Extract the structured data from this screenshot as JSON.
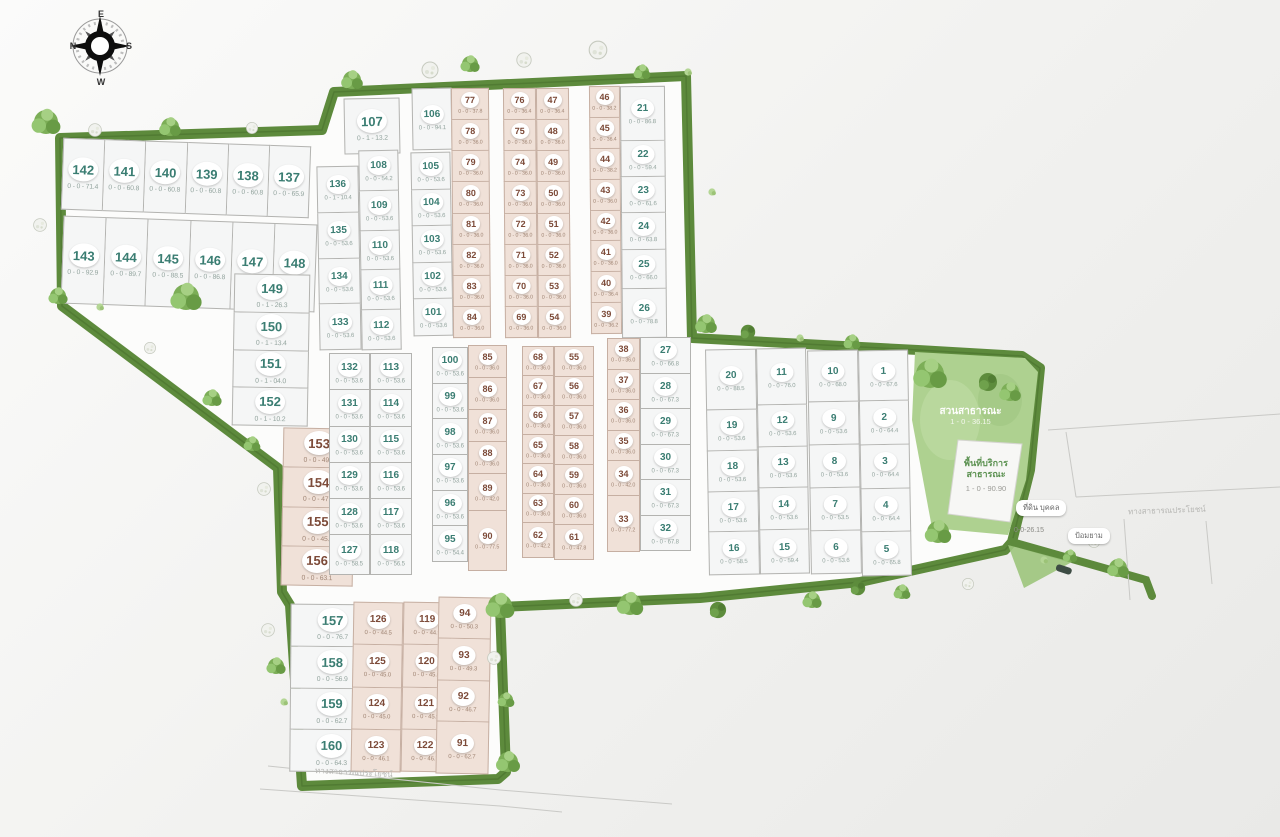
{
  "compass": {
    "n": "N",
    "e": "E",
    "s": "S",
    "w": "W"
  },
  "park": {
    "name": "สวนสาธารณะ",
    "area": "1 - 0 - 36.15"
  },
  "service": {
    "line1": "พื้นที่บริการ",
    "line2": "สาธารณะ",
    "area": "1 - 0 - 90.90"
  },
  "labels": {
    "private_land": "ที่ดิน บุคคล",
    "guard_house": "ป้อมยาม",
    "road_right": "ทางสาธารณประโยชน์",
    "road_bottom": "ทางสาธารณประโยชน์",
    "spur_area": "0-0-26.15"
  },
  "colors": {
    "plot_green_number": "#3a7d72",
    "plot_pink_number": "#7c4a38",
    "border_green": "#5d8a3c",
    "park_fill": "#aed190"
  },
  "groups": [
    {
      "id": "rowA",
      "dir": "h",
      "style": "green",
      "sz": "lg",
      "plots": [
        {
          "n": "142",
          "a": "0 - 0 - 71.4"
        },
        {
          "n": "141",
          "a": "0 - 0 - 60.8"
        },
        {
          "n": "140",
          "a": "0 - 0 - 60.8"
        },
        {
          "n": "139",
          "a": "0 - 0 - 60.8"
        },
        {
          "n": "138",
          "a": "0 - 0 - 60.8"
        },
        {
          "n": "137",
          "a": "0 - 0 - 65.9"
        }
      ]
    },
    {
      "id": "rowB",
      "dir": "h",
      "style": "green",
      "sz": "lg",
      "plots": [
        {
          "n": "143",
          "a": "0 - 0 - 92.9"
        },
        {
          "n": "144",
          "a": "0 - 0 - 89.7"
        },
        {
          "n": "145",
          "a": "0 - 0 - 88.5"
        },
        {
          "n": "146",
          "a": "0 - 0 - 86.8"
        },
        {
          "n": "147",
          "a": "0 - 0 - 78.9"
        },
        {
          "n": "148",
          "a": "0 - 0 - 80.9"
        }
      ]
    },
    {
      "id": "col149",
      "dir": "v",
      "style": "green",
      "sz": "lg",
      "plots": [
        {
          "n": "149",
          "a": "0 - 1 - 26.3"
        },
        {
          "n": "150",
          "a": "0 - 1 - 13.4"
        },
        {
          "n": "151",
          "a": "0 - 1 - 04.0"
        },
        {
          "n": "152",
          "a": "0 - 1 - 10.2"
        }
      ]
    },
    {
      "id": "col153",
      "dir": "v",
      "style": "pink",
      "sz": "lg",
      "plots": [
        {
          "n": "153",
          "a": "0 - 0 - 49.6"
        },
        {
          "n": "154",
          "a": "0 - 0 - 47.7"
        },
        {
          "n": "155",
          "a": "0 - 0 - 45.8"
        },
        {
          "n": "156",
          "a": "0 - 0 - 63.1"
        }
      ]
    },
    {
      "id": "col157",
      "dir": "v",
      "style": "green",
      "sz": "lg",
      "plots": [
        {
          "n": "157",
          "a": "0 - 0 - 76.7"
        },
        {
          "n": "158",
          "a": "0 - 0 - 56.9"
        },
        {
          "n": "159",
          "a": "0 - 0 - 62.7"
        },
        {
          "n": "160",
          "a": "0 - 0 - 64.3"
        }
      ]
    },
    {
      "id": "col126",
      "dir": "v",
      "style": "pink",
      "sz": "md",
      "plots": [
        {
          "n": "126",
          "a": "0 - 0 - 44.5"
        },
        {
          "n": "125",
          "a": "0 - 0 - 45.0"
        },
        {
          "n": "124",
          "a": "0 - 0 - 45.0"
        },
        {
          "n": "123",
          "a": "0 - 0 - 46.1"
        }
      ]
    },
    {
      "id": "col119",
      "dir": "v",
      "style": "pink",
      "sz": "md",
      "plots": [
        {
          "n": "119",
          "a": "0 - 0 - 44.9"
        },
        {
          "n": "120",
          "a": "0 - 0 - 45.0"
        },
        {
          "n": "121",
          "a": "0 - 0 - 45.9"
        },
        {
          "n": "122",
          "a": "0 - 0 - 46.7"
        }
      ]
    },
    {
      "id": "col94",
      "dir": "v",
      "style": "pink",
      "sz": "md",
      "plots": [
        {
          "n": "94",
          "a": "0 - 0 - 50.3"
        },
        {
          "n": "93",
          "a": "0 - 0 - 49.3"
        },
        {
          "n": "92",
          "a": "0 - 0 - 46.7"
        },
        {
          "n": "91",
          "a": "0 - 0 - 62.7",
          "f": 1.25
        }
      ]
    },
    {
      "id": "plot107",
      "dir": "v",
      "style": "green",
      "sz": "lg",
      "plots": [
        {
          "n": "107",
          "a": "0 - 1 - 13.2"
        }
      ]
    },
    {
      "id": "col136",
      "dir": "v",
      "style": "green",
      "sz": "md",
      "plots": [
        {
          "n": "136",
          "a": "0 - 1 - 10.4"
        },
        {
          "n": "135",
          "a": "0 - 0 - 53.6"
        },
        {
          "n": "134",
          "a": "0 - 0 - 53.6"
        },
        {
          "n": "133",
          "a": "0 - 0 - 53.6"
        }
      ]
    },
    {
      "id": "col108",
      "dir": "v",
      "style": "green",
      "sz": "md",
      "plots": [
        {
          "n": "108",
          "a": "0 - 0 - 54.2"
        },
        {
          "n": "109",
          "a": "0 - 0 - 53.6"
        },
        {
          "n": "110",
          "a": "0 - 0 - 53.6"
        },
        {
          "n": "111",
          "a": "0 - 0 - 53.6"
        },
        {
          "n": "112",
          "a": "0 - 0 - 53.6"
        }
      ]
    },
    {
      "id": "plot106",
      "dir": "v",
      "style": "green",
      "sz": "md",
      "plots": [
        {
          "n": "106",
          "a": "0 - 0 - 94.1"
        }
      ]
    },
    {
      "id": "col105",
      "dir": "v",
      "style": "green",
      "sz": "md",
      "plots": [
        {
          "n": "105",
          "a": "0 - 0 - 53.6"
        },
        {
          "n": "104",
          "a": "0 - 0 - 53.6"
        },
        {
          "n": "103",
          "a": "0 - 0 - 53.6"
        },
        {
          "n": "102",
          "a": "0 - 0 - 53.6"
        },
        {
          "n": "101",
          "a": "0 - 0 - 53.6"
        }
      ]
    },
    {
      "id": "col77",
      "dir": "v",
      "style": "pink",
      "sz": "sm",
      "plots": [
        {
          "n": "77",
          "a": "0 - 0 - 37.8"
        },
        {
          "n": "78",
          "a": "0 - 0 - 36.0"
        },
        {
          "n": "79",
          "a": "0 - 0 - 36.0"
        },
        {
          "n": "80",
          "a": "0 - 0 - 36.0"
        },
        {
          "n": "81",
          "a": "0 - 0 - 36.0"
        },
        {
          "n": "82",
          "a": "0 - 0 - 36.0"
        },
        {
          "n": "83",
          "a": "0 - 0 - 36.0"
        },
        {
          "n": "84",
          "a": "0 - 0 - 36.0"
        }
      ]
    },
    {
      "id": "col76",
      "dir": "v",
      "style": "pink",
      "sz": "sm",
      "plots": [
        {
          "n": "76",
          "a": "0 - 0 - 36.4"
        },
        {
          "n": "75",
          "a": "0 - 0 - 36.0"
        },
        {
          "n": "74",
          "a": "0 - 0 - 36.0"
        },
        {
          "n": "73",
          "a": "0 - 0 - 36.0"
        },
        {
          "n": "72",
          "a": "0 - 0 - 36.0"
        },
        {
          "n": "71",
          "a": "0 - 0 - 36.0"
        },
        {
          "n": "70",
          "a": "0 - 0 - 36.0"
        },
        {
          "n": "69",
          "a": "0 - 0 - 36.0"
        }
      ]
    },
    {
      "id": "col47",
      "dir": "v",
      "style": "pink",
      "sz": "sm",
      "plots": [
        {
          "n": "47",
          "a": "0 - 0 - 36.4"
        },
        {
          "n": "48",
          "a": "0 - 0 - 36.0"
        },
        {
          "n": "49",
          "a": "0 - 0 - 36.0"
        },
        {
          "n": "50",
          "a": "0 - 0 - 36.0"
        },
        {
          "n": "51",
          "a": "0 - 0 - 36.0"
        },
        {
          "n": "52",
          "a": "0 - 0 - 36.0"
        },
        {
          "n": "53",
          "a": "0 - 0 - 36.0"
        },
        {
          "n": "54",
          "a": "0 - 0 - 36.0"
        }
      ]
    },
    {
      "id": "col46",
      "dir": "v",
      "style": "pink",
      "sz": "sm",
      "plots": [
        {
          "n": "46",
          "a": "0 - 0 - 38.2"
        },
        {
          "n": "45",
          "a": "0 - 0 - 36.4"
        },
        {
          "n": "44",
          "a": "0 - 0 - 38.2"
        },
        {
          "n": "43",
          "a": "0 - 0 - 36.0"
        },
        {
          "n": "42",
          "a": "0 - 0 - 36.0"
        },
        {
          "n": "41",
          "a": "0 - 0 - 36.0"
        },
        {
          "n": "40",
          "a": "0 - 0 - 36.4"
        },
        {
          "n": "39",
          "a": "0 - 0 - 36.2"
        }
      ]
    },
    {
      "id": "col21",
      "dir": "v",
      "style": "green",
      "sz": "md",
      "plots": [
        {
          "n": "21",
          "a": "0 - 0 - 86.8",
          "f": 1.5
        },
        {
          "n": "22",
          "a": "0 - 0 - 59.4"
        },
        {
          "n": "23",
          "a": "0 - 0 - 61.6"
        },
        {
          "n": "24",
          "a": "0 - 0 - 63.8"
        },
        {
          "n": "25",
          "a": "0 - 0 - 66.0",
          "f": 1.1
        },
        {
          "n": "26",
          "a": "0 - 0 - 78.8",
          "f": 1.35
        }
      ]
    },
    {
      "id": "col132",
      "dir": "v",
      "style": "green",
      "sz": "md",
      "plots": [
        {
          "n": "132",
          "a": "0 - 0 - 53.6"
        },
        {
          "n": "131",
          "a": "0 - 0 - 53.6"
        },
        {
          "n": "130",
          "a": "0 - 0 - 53.6"
        },
        {
          "n": "129",
          "a": "0 - 0 - 53.6"
        },
        {
          "n": "128",
          "a": "0 - 0 - 53.6"
        },
        {
          "n": "127",
          "a": "0 - 0 - 58.5",
          "f": 1.1
        }
      ]
    },
    {
      "id": "col113",
      "dir": "v",
      "style": "green",
      "sz": "md",
      "plots": [
        {
          "n": "113",
          "a": "0 - 0 - 53.6"
        },
        {
          "n": "114",
          "a": "0 - 0 - 53.6"
        },
        {
          "n": "115",
          "a": "0 - 0 - 53.6"
        },
        {
          "n": "116",
          "a": "0 - 0 - 53.6"
        },
        {
          "n": "117",
          "a": "0 - 0 - 53.6"
        },
        {
          "n": "118",
          "a": "0 - 0 - 56.5",
          "f": 1.1
        }
      ]
    },
    {
      "id": "col100",
      "dir": "v",
      "style": "green",
      "sz": "md",
      "plots": [
        {
          "n": "100",
          "a": "0 - 0 - 53.6"
        },
        {
          "n": "99",
          "a": "0 - 0 - 53.6"
        },
        {
          "n": "98",
          "a": "0 - 0 - 53.6"
        },
        {
          "n": "97",
          "a": "0 - 0 - 53.6"
        },
        {
          "n": "96",
          "a": "0 - 0 - 53.6"
        },
        {
          "n": "95",
          "a": "0 - 0 - 54.4"
        }
      ]
    },
    {
      "id": "col85",
      "dir": "v",
      "style": "pink",
      "sz": "sm",
      "plots": [
        {
          "n": "85",
          "a": "0 - 0 - 36.0"
        },
        {
          "n": "86",
          "a": "0 - 0 - 36.0"
        },
        {
          "n": "87",
          "a": "0 - 0 - 36.0"
        },
        {
          "n": "88",
          "a": "0 - 0 - 36.0"
        },
        {
          "n": "89",
          "a": "0 - 0 - 42.0",
          "f": 1.15
        },
        {
          "n": "90",
          "a": "0 - 0 - 77.5",
          "f": 1.9
        }
      ]
    },
    {
      "id": "col68",
      "dir": "v",
      "style": "pink",
      "sz": "sm",
      "plots": [
        {
          "n": "68",
          "a": "0 - 0 - 36.0"
        },
        {
          "n": "67",
          "a": "0 - 0 - 36.0"
        },
        {
          "n": "66",
          "a": "0 - 0 - 36.0"
        },
        {
          "n": "65",
          "a": "0 - 0 - 36.0"
        },
        {
          "n": "64",
          "a": "0 - 0 - 36.0"
        },
        {
          "n": "63",
          "a": "0 - 0 - 36.0"
        },
        {
          "n": "62",
          "a": "0 - 0 - 42.2",
          "f": 1.2
        }
      ]
    },
    {
      "id": "col55",
      "dir": "v",
      "style": "pink",
      "sz": "sm",
      "plots": [
        {
          "n": "55",
          "a": "0 - 0 - 36.0"
        },
        {
          "n": "56",
          "a": "0 - 0 - 36.0"
        },
        {
          "n": "57",
          "a": "0 - 0 - 36.0"
        },
        {
          "n": "58",
          "a": "0 - 0 - 36.0"
        },
        {
          "n": "59",
          "a": "0 - 0 - 36.0"
        },
        {
          "n": "60",
          "a": "0 - 0 - 36.0"
        },
        {
          "n": "61",
          "a": "0 - 0 - 47.8",
          "f": 1.2
        }
      ]
    },
    {
      "id": "col38",
      "dir": "v",
      "style": "pink",
      "sz": "sm",
      "plots": [
        {
          "n": "38",
          "a": "0 - 0 - 36.0"
        },
        {
          "n": "37",
          "a": "0 - 0 - 36.0"
        },
        {
          "n": "36",
          "a": "0 - 0 - 36.0"
        },
        {
          "n": "35",
          "a": "0 - 0 - 36.0"
        },
        {
          "n": "34",
          "a": "0 - 0 - 42.0",
          "f": 1.15
        },
        {
          "n": "33",
          "a": "0 - 0 - 77.2",
          "f": 1.85
        }
      ]
    },
    {
      "id": "col27",
      "dir": "v",
      "style": "green",
      "sz": "md",
      "plots": [
        {
          "n": "27",
          "a": "0 - 0 - 66.8"
        },
        {
          "n": "28",
          "a": "0 - 0 - 67.3"
        },
        {
          "n": "29",
          "a": "0 - 0 - 67.3"
        },
        {
          "n": "30",
          "a": "0 - 0 - 67.3"
        },
        {
          "n": "31",
          "a": "0 - 0 - 67.3"
        },
        {
          "n": "32",
          "a": "0 - 0 - 67.8"
        }
      ]
    },
    {
      "id": "col20",
      "dir": "v",
      "style": "green",
      "sz": "md",
      "plots": [
        {
          "n": "20",
          "a": "0 - 0 - 88.5",
          "f": 1.5
        },
        {
          "n": "19",
          "a": "0 - 0 - 53.6"
        },
        {
          "n": "18",
          "a": "0 - 0 - 53.6"
        },
        {
          "n": "17",
          "a": "0 - 0 - 53.6"
        },
        {
          "n": "16",
          "a": "0 - 0 - 58.5",
          "f": 1.05
        }
      ]
    },
    {
      "id": "col11",
      "dir": "v",
      "style": "green",
      "sz": "md",
      "plots": [
        {
          "n": "11",
          "a": "0 - 0 - 76.0",
          "f": 1.35
        },
        {
          "n": "12",
          "a": "0 - 0 - 53.6"
        },
        {
          "n": "13",
          "a": "0 - 0 - 53.6"
        },
        {
          "n": "14",
          "a": "0 - 0 - 53.6"
        },
        {
          "n": "15",
          "a": "0 - 0 - 59.4",
          "f": 1.05
        }
      ]
    },
    {
      "id": "col10",
      "dir": "v",
      "style": "green",
      "sz": "md",
      "plots": [
        {
          "n": "10",
          "a": "0 - 0 - 68.0",
          "f": 1.2
        },
        {
          "n": "9",
          "a": "0 - 0 - 53.6"
        },
        {
          "n": "8",
          "a": "0 - 0 - 53.6"
        },
        {
          "n": "7",
          "a": "0 - 0 - 53.5"
        },
        {
          "n": "6",
          "a": "0 - 0 - 53.6"
        }
      ]
    },
    {
      "id": "col1",
      "dir": "v",
      "style": "green",
      "sz": "md",
      "plots": [
        {
          "n": "1",
          "a": "0 - 0 - 67.6",
          "f": 1.15
        },
        {
          "n": "2",
          "a": "0 - 0 - 64.4"
        },
        {
          "n": "3",
          "a": "0 - 0 - 64.4"
        },
        {
          "n": "4",
          "a": "0 - 0 - 64.4"
        },
        {
          "n": "5",
          "a": "0 - 0 - 65.8"
        }
      ]
    }
  ]
}
